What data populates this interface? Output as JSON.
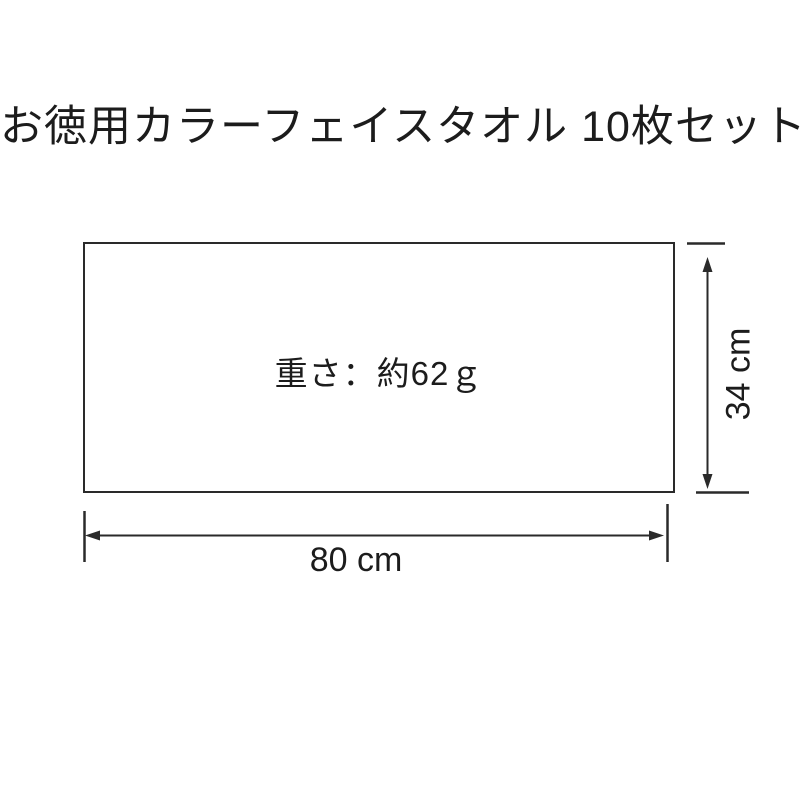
{
  "title": "お徳用カラーフェイスタオル 10枚セット",
  "diagram": {
    "weight_label": "重さ：約62ｇ",
    "width_value": "80 cm",
    "height_value": "34 cm"
  },
  "colors": {
    "ink": "#1c1c1c",
    "line": "#2a2a2a",
    "background": "#ffffff"
  }
}
